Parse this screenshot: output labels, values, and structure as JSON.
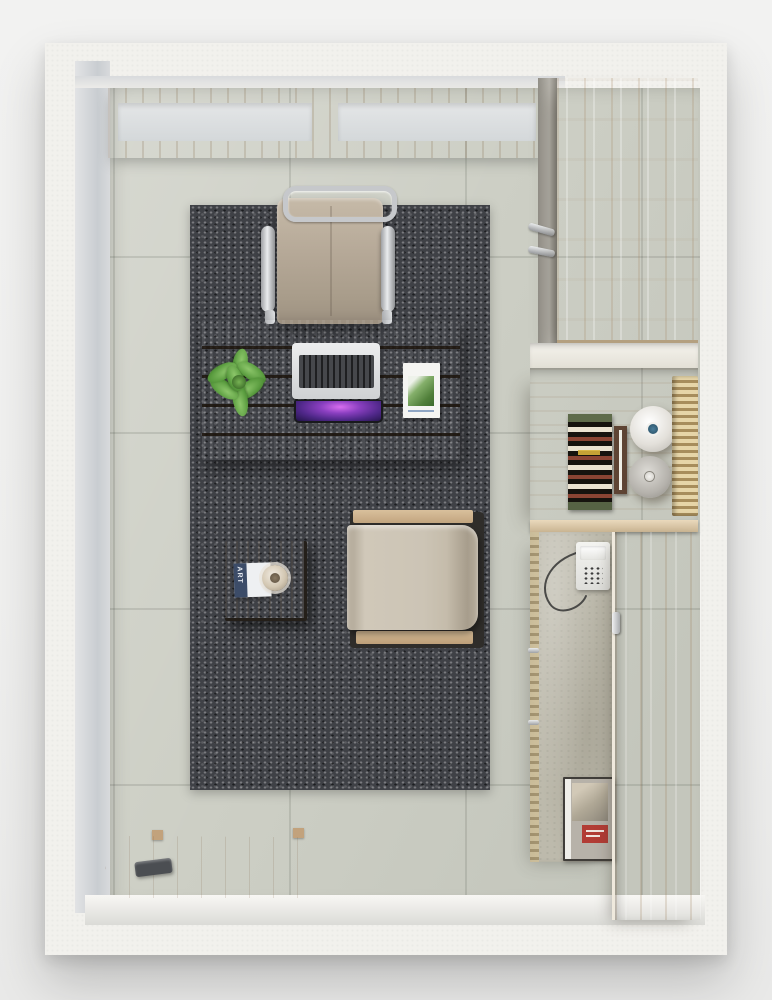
{
  "page": {
    "description": "Top-down 3D render of a small home office room with white plaster walls, tiled floor, a charcoal rug, a plank desk with laptop, an office chair, an armchair, a side table and light-wood cabinetry along the right wall"
  },
  "texts": {
    "magazine_title": "ART"
  },
  "palette": {
    "backdrop": "#f0f0ef",
    "wall": "#f2f1ed",
    "wall_bevel": "#ccd0d3",
    "floor_tile": "#cdcfc5",
    "floor_grout": "#b6b8ae",
    "rug": "#3f4146",
    "desk_wood": "#c7ab89",
    "cabinet_wood": "#ddccb2",
    "door_wood": "#d2bb99",
    "concrete_panel": "#bdbaac",
    "chair_upholstery": "#b5a897",
    "armchair_fabric": "#ccc4b5",
    "chrome": "#c9cbce",
    "laptop_screen": "#8a3fc0",
    "plant_green": "#5a9c3f",
    "artwork_red": "#8a4433",
    "artwork_band_green": "#5f6b4a",
    "book_label_red": "#b23c35",
    "window_glass": "#dfe2e4",
    "window_frame": "#c9b28e"
  },
  "objects": {
    "walls": {
      "label": "White plaster walls (top-down)"
    },
    "window": {
      "label": "Wood-framed window, two panes"
    },
    "floor": {
      "label": "Large-format tiled floor"
    },
    "rug": {
      "label": "Charcoal speckled rug"
    },
    "desk": {
      "label": "Wooden plank desk"
    },
    "office_chair": {
      "label": "Office chair, chrome frame, beige upholstery"
    },
    "plant": {
      "label": "Green potted plant"
    },
    "laptop": {
      "label": "Open silver laptop with purple wallpaper"
    },
    "document": {
      "label": "White document with green graphic"
    },
    "side_table": {
      "label": "Square wooden side table"
    },
    "magazine": {
      "label": "ART magazine"
    },
    "cup": {
      "label": "Cup on saucer"
    },
    "armchair": {
      "label": "Lounge armchair with wooden armrests"
    },
    "wood_board": {
      "label": "Wooden board with dark handle"
    },
    "wardrobe": {
      "label": "Tall light-wood wardrobe"
    },
    "coat_hooks": {
      "label": "Chrome wall hooks"
    },
    "shelf": {
      "label": "White shelf niche"
    },
    "console": {
      "label": "Wooden console recess"
    },
    "artwork": {
      "label": "Framed graphic artwork with wave pattern"
    },
    "art_frame": {
      "label": "Dark wood picture frame"
    },
    "vase_white": {
      "label": "White ceramic vase"
    },
    "vase_gray": {
      "label": "Gray ceramic vase"
    },
    "bamboo_mat": {
      "label": "Bamboo slat runner"
    },
    "telephone": {
      "label": "White corded telephone"
    },
    "book": {
      "label": "Book with red label"
    },
    "cabinet_door": {
      "label": "Open cabinet door"
    }
  }
}
